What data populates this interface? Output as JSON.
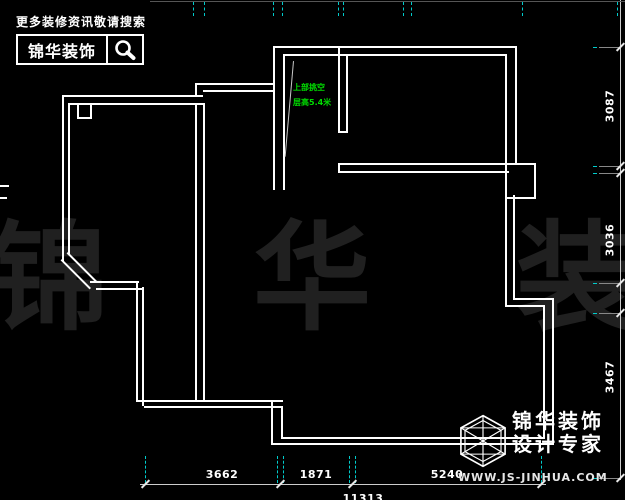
{
  "header": {
    "tagline": "更多装修资讯敬请搜索",
    "brand": "锦华装饰",
    "icon": "magnifier-icon"
  },
  "footer_logo": {
    "brand_line1": "锦华装饰",
    "brand_line2": "设计专家",
    "url": "WWW.JS-JINHUA.COM",
    "icon": "cube-logo"
  },
  "watermark": {
    "text": "锦 华 装 饰"
  },
  "annotation": {
    "line1": "上部挑空",
    "line2": "层高5.4米"
  },
  "dimensions": {
    "bottom": [
      {
        "label": "3662",
        "cx": 222
      },
      {
        "label": "1871",
        "cx": 316
      },
      {
        "label": "5240",
        "cx": 447
      }
    ],
    "bottom_total": {
      "label": "11313",
      "cx": 363
    },
    "right": [
      {
        "label": "3087",
        "cy": 106
      },
      {
        "label": "3036",
        "cy": 240
      },
      {
        "label": "3467",
        "cy": 377
      }
    ]
  },
  "colors": {
    "background": "#000000",
    "wall": "#ffffff",
    "dimension_text": "#ffffff",
    "extension_cyan": "#00cccc",
    "annotation_green": "#00dd00",
    "watermark_gray": "#202020"
  },
  "floor_plan": {
    "walls": [
      {
        "x": 273,
        "y": 46,
        "w": 244,
        "h": 2
      },
      {
        "x": 283,
        "y": 54,
        "w": 224,
        "h": 2
      },
      {
        "x": 515,
        "y": 46,
        "w": 2,
        "h": 119
      },
      {
        "x": 505,
        "y": 54,
        "w": 2,
        "h": 111
      },
      {
        "x": 513,
        "y": 195,
        "w": 2,
        "h": 105
      },
      {
        "x": 505,
        "y": 195,
        "w": 2,
        "h": 112
      },
      {
        "x": 513,
        "y": 298,
        "w": 41,
        "h": 2
      },
      {
        "x": 505,
        "y": 305,
        "w": 40,
        "h": 2
      },
      {
        "x": 552,
        "y": 298,
        "w": 2,
        "h": 147
      },
      {
        "x": 543,
        "y": 305,
        "w": 2,
        "h": 134
      },
      {
        "x": 271,
        "y": 443,
        "w": 283,
        "h": 2
      },
      {
        "x": 281,
        "y": 437,
        "w": 264,
        "h": 2
      },
      {
        "x": 271,
        "y": 400,
        "w": 2,
        "h": 45
      },
      {
        "x": 281,
        "y": 406,
        "w": 2,
        "h": 33
      },
      {
        "x": 136,
        "y": 400,
        "w": 147,
        "h": 2
      },
      {
        "x": 144,
        "y": 406,
        "w": 139,
        "h": 2
      },
      {
        "x": 136,
        "y": 281,
        "w": 2,
        "h": 121
      },
      {
        "x": 142,
        "y": 287,
        "w": 2,
        "h": 119
      },
      {
        "x": 90,
        "y": 281,
        "w": 49,
        "h": 2
      },
      {
        "x": 96,
        "y": 288,
        "w": 48,
        "h": 2
      },
      {
        "x": 62,
        "y": 259,
        "w": 41,
        "h": 2,
        "rot": 45
      },
      {
        "x": 68,
        "y": 252,
        "w": 41,
        "h": 2,
        "rot": 45
      },
      {
        "x": 62,
        "y": 95,
        "w": 2,
        "h": 166
      },
      {
        "x": 68,
        "y": 103,
        "w": 2,
        "h": 151
      },
      {
        "x": 62,
        "y": 95,
        "w": 141,
        "h": 2
      },
      {
        "x": 68,
        "y": 103,
        "w": 135,
        "h": 2
      },
      {
        "x": 195,
        "y": 83,
        "w": 2,
        "h": 14
      },
      {
        "x": 195,
        "y": 83,
        "w": 80,
        "h": 2
      },
      {
        "x": 203,
        "y": 90,
        "w": 72,
        "h": 2
      },
      {
        "x": 273,
        "y": 46,
        "w": 2,
        "h": 144
      },
      {
        "x": 283,
        "y": 54,
        "w": 2,
        "h": 136
      },
      {
        "x": 195,
        "y": 103,
        "w": 2,
        "h": 299
      },
      {
        "x": 203,
        "y": 103,
        "w": 2,
        "h": 299
      },
      {
        "x": 338,
        "y": 46,
        "w": 2,
        "h": 87
      },
      {
        "x": 346,
        "y": 54,
        "w": 2,
        "h": 79
      },
      {
        "x": 338,
        "y": 131,
        "w": 10,
        "h": 2
      },
      {
        "x": 338,
        "y": 163,
        "w": 171,
        "h": 2
      },
      {
        "x": 338,
        "y": 171,
        "w": 171,
        "h": 2
      },
      {
        "x": 338,
        "y": 163,
        "w": 2,
        "h": 10
      },
      {
        "x": 293,
        "y": 61,
        "w": 1,
        "h": 96,
        "rot": 5,
        "thin": true
      },
      {
        "x": 0,
        "y": 185,
        "w": 9,
        "h": 2
      },
      {
        "x": 0,
        "y": 197,
        "w": 7,
        "h": 2
      }
    ],
    "boxes": [
      {
        "name": "pier-box",
        "x": 505,
        "y": 163,
        "w": 27,
        "h": 32
      },
      {
        "name": "column-box",
        "x": 77,
        "y": 103,
        "w": 11,
        "h": 12
      }
    ],
    "dim_lines": [
      {
        "name": "bottom-dimension-line",
        "x": 140,
        "y": 484,
        "w": 406,
        "h": 1
      },
      {
        "name": "right-dimension-line",
        "x": 620,
        "y": 0,
        "w": 1,
        "h": 480
      },
      {
        "name": "top-dimension-line",
        "x": 150,
        "y": 1,
        "w": 475,
        "h": 1,
        "faint": true
      }
    ],
    "bottom_ticks": [
      145,
      280,
      352,
      541
    ],
    "bottom_ext": [
      145,
      277,
      283,
      349,
      355,
      541
    ],
    "right_ticks": [
      47,
      166,
      173,
      283,
      313,
      478
    ],
    "right_ext": [
      47,
      166,
      173,
      283,
      313,
      478
    ],
    "top_ext": [
      193,
      204,
      273,
      282,
      338,
      343,
      403,
      411,
      522,
      617
    ]
  }
}
